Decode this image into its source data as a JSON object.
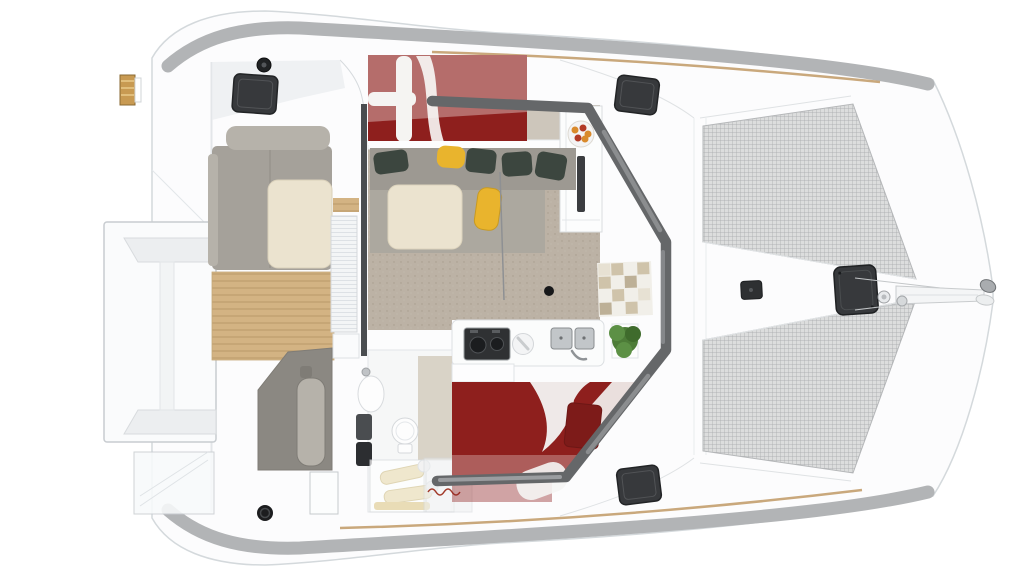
{
  "colors": {
    "background": "#ffffff",
    "hull": "#fcfcfd",
    "hull_line": "#d4d9dc",
    "deck_band": "#b2b4b6",
    "toe_rail": "#c9a87c",
    "trampoline": "#dcdddd",
    "trampoline_grid": "#a5a7a9",
    "teak": "#d3b383",
    "teak_gap": "#bfa070",
    "floor_taupe": "#bcb2a5",
    "floor_light": "#cdc6bb",
    "sofa_back": "#9d9992",
    "sofa_seat": "#aca89f",
    "cockpit_seat": "#a5a19a",
    "cockpit_seat_light": "#b6b2aa",
    "helm_bench": "#8b8882",
    "table_cream": "#ebe3cf",
    "cushion_green": "#3c463f",
    "cushion_yellow": "#e9b42d",
    "bed_red": "#8e1f1d",
    "pillow_red": "#7d1b19",
    "linen_white": "#f5f4f2",
    "window_tint": "#656769",
    "window_tint_hi": "#8b8d8f",
    "hatch": "#37393c",
    "hatch_dark": "#232527",
    "plant": "#4d7c38",
    "plant_light": "#5c9045",
    "plant_dark": "#3f6b2c",
    "steel": "#c2c6c9",
    "steel_dark": "#8f9396",
    "stove_black": "#2f3133",
    "fitting_black": "#1c1d1f",
    "tile_a": "#cfc3aa",
    "tile_b": "#bdb097",
    "tile_c": "#e7e1d3",
    "bath_floor": "#d9d3c7",
    "towel": "#efe7cd",
    "mat_tan": "#e9dcb6",
    "fruit_orange": "#d98a2b",
    "fruit_red": "#b23a26",
    "bowl": "#f3f4f5",
    "ladder_wood": "#c89a52"
  }
}
